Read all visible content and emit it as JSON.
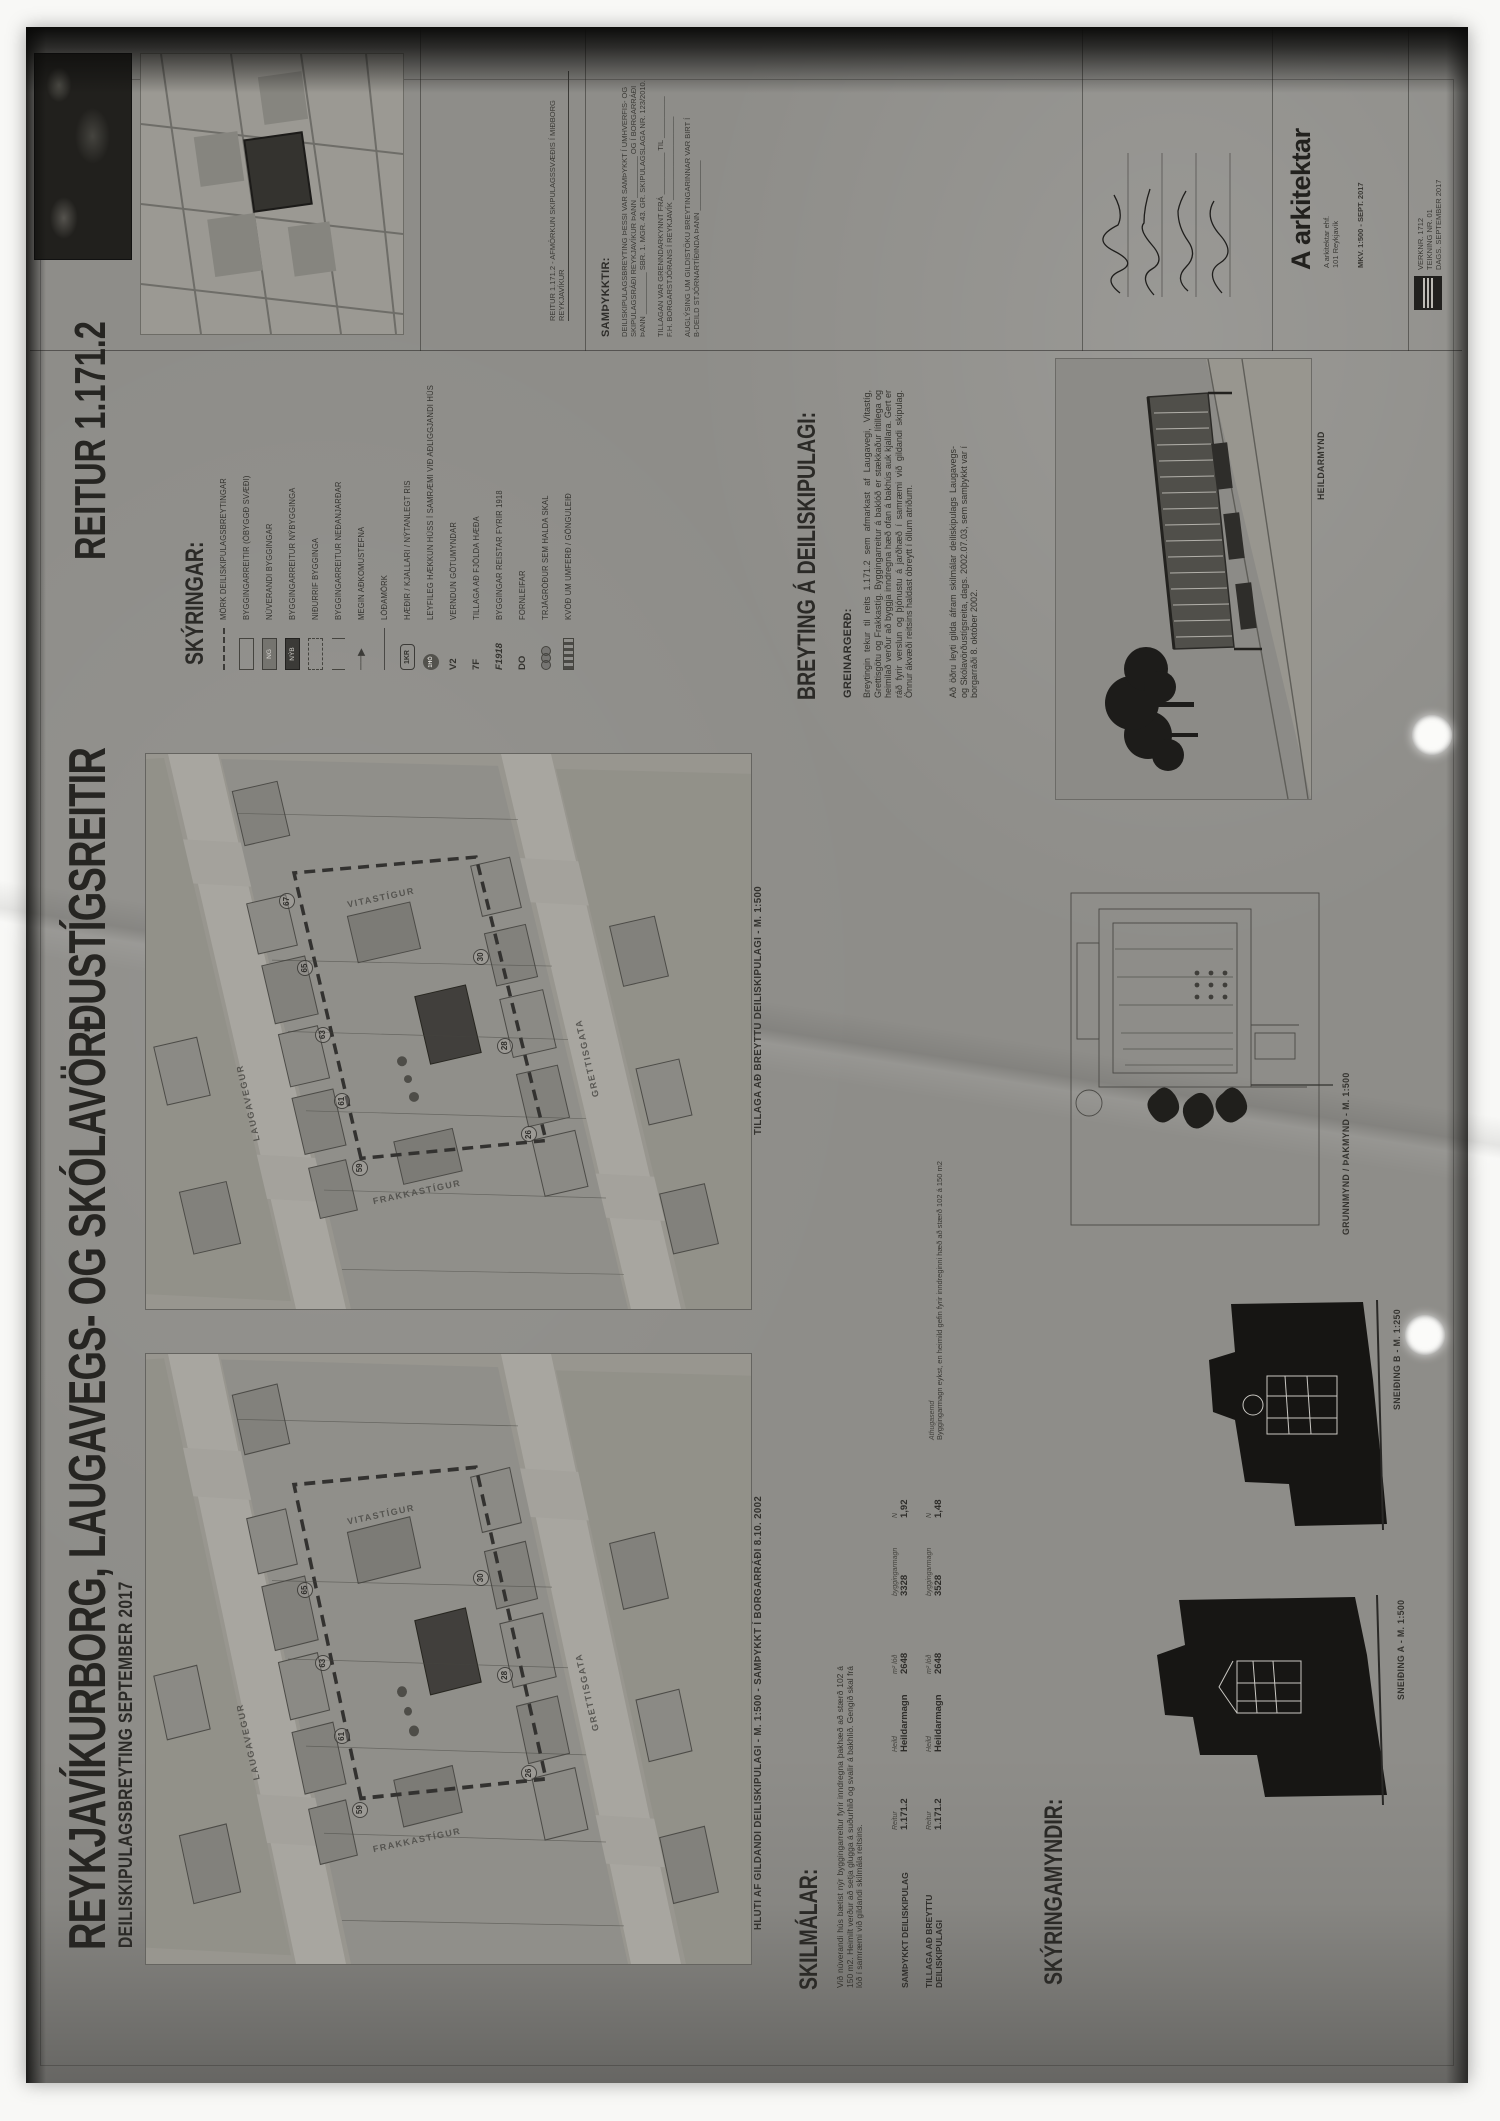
{
  "colors": {
    "paper": "#8e8d89",
    "ink": "#2e2d2a",
    "map_panel": "#989692",
    "street": "#a6a49e",
    "new_building": "#3b3a37",
    "scan_shadow": "#0b0b0a",
    "hole_punch": "#fbfbf9"
  },
  "header": {
    "title": "REYKJAVÍKURBORG, LAUGAVEGS- OG SKÓLAVÖRÐUSTÍGSREITIR",
    "subtitle": "DEILISKIPULAGSBREYTING SEPTEMBER 2017",
    "sheet": "REITUR 1.171.2"
  },
  "legend": {
    "heading": "SKÝRINGAR:",
    "items": [
      {
        "sym": "dash",
        "swatch": "",
        "text": "MÖRK DEILISKIPULAGSBREYTINGAR"
      },
      {
        "sym": "rect",
        "swatch": "",
        "text": "BYGGINGARREITIR (ÓBYGGÐ SVÆÐI)"
      },
      {
        "sym": "grey",
        "swatch": "NG",
        "text": "NÚVERANDI BYGGINGAR"
      },
      {
        "sym": "dark",
        "swatch": "NÝB",
        "text": "BYGGINGARREITUR NÝBYGGINGA"
      },
      {
        "sym": "rect2",
        "swatch": "",
        "text": "NIÐURRIF BYGGINGA"
      },
      {
        "sym": "brk",
        "swatch": "",
        "text": "BYGGINGARREITUR NEÐANJARÐAR"
      },
      {
        "sym": "arrow",
        "swatch": "",
        "text": "MEGIN AÐKOMUSTEFNA"
      },
      {
        "sym": "thin",
        "swatch": "",
        "text": "LÓÐAMÖRK"
      },
      {
        "sym": "oct",
        "swatch": "1KR",
        "text": "HÆÐIR / KJALLARI / NÝTANLEGT RIS"
      },
      {
        "sym": "cir",
        "swatch": "1HÓ",
        "text": "LEYFILEG HÆKKUN HÚSS Í SAMRÆMI VIÐ AÐLIGGJANDI HÚS"
      },
      {
        "sym": "txt",
        "swatch": "V2",
        "text": "VERNDUN GÖTUMYNDAR"
      },
      {
        "sym": "txt",
        "swatch": "7F",
        "text": "TILLAGA AÐ FJÖLDA HÆÐA"
      },
      {
        "sym": "itxt",
        "swatch": "F1918",
        "text": "BYGGINGAR REISTAR FYRIR 1918"
      },
      {
        "sym": "txt",
        "swatch": "DO",
        "text": "FORNLEIFAR"
      },
      {
        "sym": "tree",
        "swatch": "",
        "text": "TRJÁGRÓÐUR SEM HALDA SKAL"
      },
      {
        "sym": "hatch",
        "swatch": "",
        "text": "KVÖÐ UM UMFERÐ / GÖNGULEIÐ"
      }
    ]
  },
  "breyting": {
    "heading": "BREYTING Á DEILISKIPULAGI:",
    "subheading": "GREINARGERÐ:",
    "para1": "Breytingin tekur til reits 1.171.2 sem afmarkast af Laugavegi, Vitastíg, Grettisgötu og Frakkastíg. Byggingarreitur á baklóð er stækkaður lítillega og heimilað verður að byggja inndregna hæð ofan á bakhús auk kjallara. Gert er ráð fyrir verslun og þjónustu á jarðhæð í samræmi við gildandi skipulag. Önnur ákvæði reitsins haldast óbreytt í öllum atriðum.",
    "para2": "Að öðru leyti gilda áfram skilmálar deiliskipulags Laugavegs- og Skólavörðustígsreita, dags. 2002.07.03, sem samþykkt var í borgarráði 8. október 2002."
  },
  "maps": {
    "proposed_caption": "TILLAGA AÐ BREYTTU DEILISKIPULAGI - M. 1:500",
    "existing_caption": "HLUTI AF GILDANDI DEILISKIPULAGI - M. 1:500 - SAMÞYKKT Í BORGARRÁÐI 8.10. 2002",
    "streets": [
      {
        "m": 1,
        "x": 30,
        "y": 16,
        "r": -13,
        "t": "LAUGAVEGUR"
      },
      {
        "m": 1,
        "x": 38,
        "y": 72,
        "r": -13,
        "t": "GRETTISGATA"
      },
      {
        "m": 1,
        "x": 13,
        "y": 44,
        "r": 78,
        "t": "FRAKKASTÍGUR"
      },
      {
        "m": 1,
        "x": 68,
        "y": 38,
        "r": 78,
        "t": "VITASTÍGUR"
      },
      {
        "m": 2,
        "x": 30,
        "y": 16,
        "r": -13,
        "t": "LAUGAVEGUR"
      },
      {
        "m": 2,
        "x": 38,
        "y": 72,
        "r": -13,
        "t": "GRETTISGATA"
      },
      {
        "m": 2,
        "x": 13,
        "y": 44,
        "r": 78,
        "t": "FRAKKASTÍGUR"
      },
      {
        "m": 2,
        "x": 68,
        "y": 38,
        "r": 78,
        "t": "VITASTÍGUR"
      }
    ],
    "plots": [
      {
        "m": 1,
        "x": 24,
        "y": 34,
        "n": "59"
      },
      {
        "m": 1,
        "x": 36,
        "y": 31,
        "n": "61"
      },
      {
        "m": 1,
        "x": 48,
        "y": 28,
        "n": "63"
      },
      {
        "m": 1,
        "x": 60,
        "y": 25,
        "n": "65"
      },
      {
        "m": 1,
        "x": 72,
        "y": 22,
        "n": "67"
      },
      {
        "m": 1,
        "x": 30,
        "y": 62,
        "n": "26"
      },
      {
        "m": 1,
        "x": 46,
        "y": 58,
        "n": "28"
      },
      {
        "m": 1,
        "x": 62,
        "y": 54,
        "n": "30"
      },
      {
        "m": 2,
        "x": 24,
        "y": 34,
        "n": "59"
      },
      {
        "m": 2,
        "x": 36,
        "y": 31,
        "n": "61"
      },
      {
        "m": 2,
        "x": 48,
        "y": 28,
        "n": "63"
      },
      {
        "m": 2,
        "x": 60,
        "y": 25,
        "n": "65"
      },
      {
        "m": 2,
        "x": 30,
        "y": 62,
        "n": "26"
      },
      {
        "m": 2,
        "x": 46,
        "y": 58,
        "n": "28"
      },
      {
        "m": 2,
        "x": 62,
        "y": 54,
        "n": "30"
      }
    ]
  },
  "skilmalar": {
    "heading": "SKILMÁLAR:",
    "para": "Við núverandi hús bætist nýr byggingarreitur fyrir inndregna þakhæð að stærð 102 á 150 m2. Heimilt verður að setja glugga á suðurhlið og svalir á bakhlið. Gengið skal frá lóð í samræmi við gildandi skilmála reitsins.",
    "table": {
      "headers": [
        "Reitur",
        "Heild",
        "m² lóð",
        "byggingarmagn",
        "N"
      ],
      "note_header": "Athugasemd",
      "rows": [
        {
          "name": "SAMÞYKKT DEILISKIPULAG",
          "cells": [
            "1.171.2",
            "Heildarmagn",
            "2648",
            "3328",
            "1,92"
          ],
          "note": ""
        },
        {
          "name": "TILLAGA AÐ BREYTTU DEILISKIPULAGI",
          "cells": [
            "1.171.2",
            "Heildarmagn",
            "2648",
            "3528",
            "1,48"
          ],
          "note": "Byggingarmagn eykst, en heimild gefin fyrir inndreginni hæð að stærð 102 á 150 m2"
        }
      ]
    }
  },
  "myndir": {
    "heading": "SKÝRINGAMYNDIR:",
    "section_a": "SNEIÐING A - M. 1:500",
    "section_b": "SNEIÐING B - M. 1:250",
    "plan": "GRUNNMYND / ÞAKMYND - M. 1:500",
    "render": "HEILDARMYND"
  },
  "titleblock": {
    "siteplan_caption": "REITUR 1.171.2 - AFMÖRKUN SKIPULAGSSVÆÐIS Í MIÐBORG REYKJAVÍKUR",
    "samthykktir_heading": "SAMÞYKKTIR:",
    "lines": [
      "DEILISKIPULAGSBREYTING ÞESSI VAR SAMÞYKKT Í UMHVERFIS- OG",
      "SKIPULAGSRÁÐI REYKJAVÍKUR ÞANN __________ OG Í BORGARRÁÐI",
      "ÞANN __________ SBR. 1. MGR. 43. GR. SKIPULAGSLAGA NR. 123/2010.",
      "",
      "TILLAGAN VAR GRENNDARKYNNT FRÁ __________ TIL __________",
      "F.H. BORGARSTJÓRANS Í REYKJAVÍK ____________________",
      "",
      "AUGLÝSING UM GILDISTÖKU BREYTINGARINNAR VAR BIRT Í",
      "B-DEILD STJÓRNARTÍÐINDA ÞANN ____________"
    ],
    "firm": "A arkitektar",
    "firm_lines": [
      "A arkitektar ehf.",
      "101 Reykjavík"
    ],
    "scale_line": "MKV. 1:500 - SEPT. 2017",
    "corner_lines": [
      "VERKNR. 1712",
      "TEIKNING NR. 01",
      "DAGS. SEPTEMBER 2017"
    ]
  }
}
